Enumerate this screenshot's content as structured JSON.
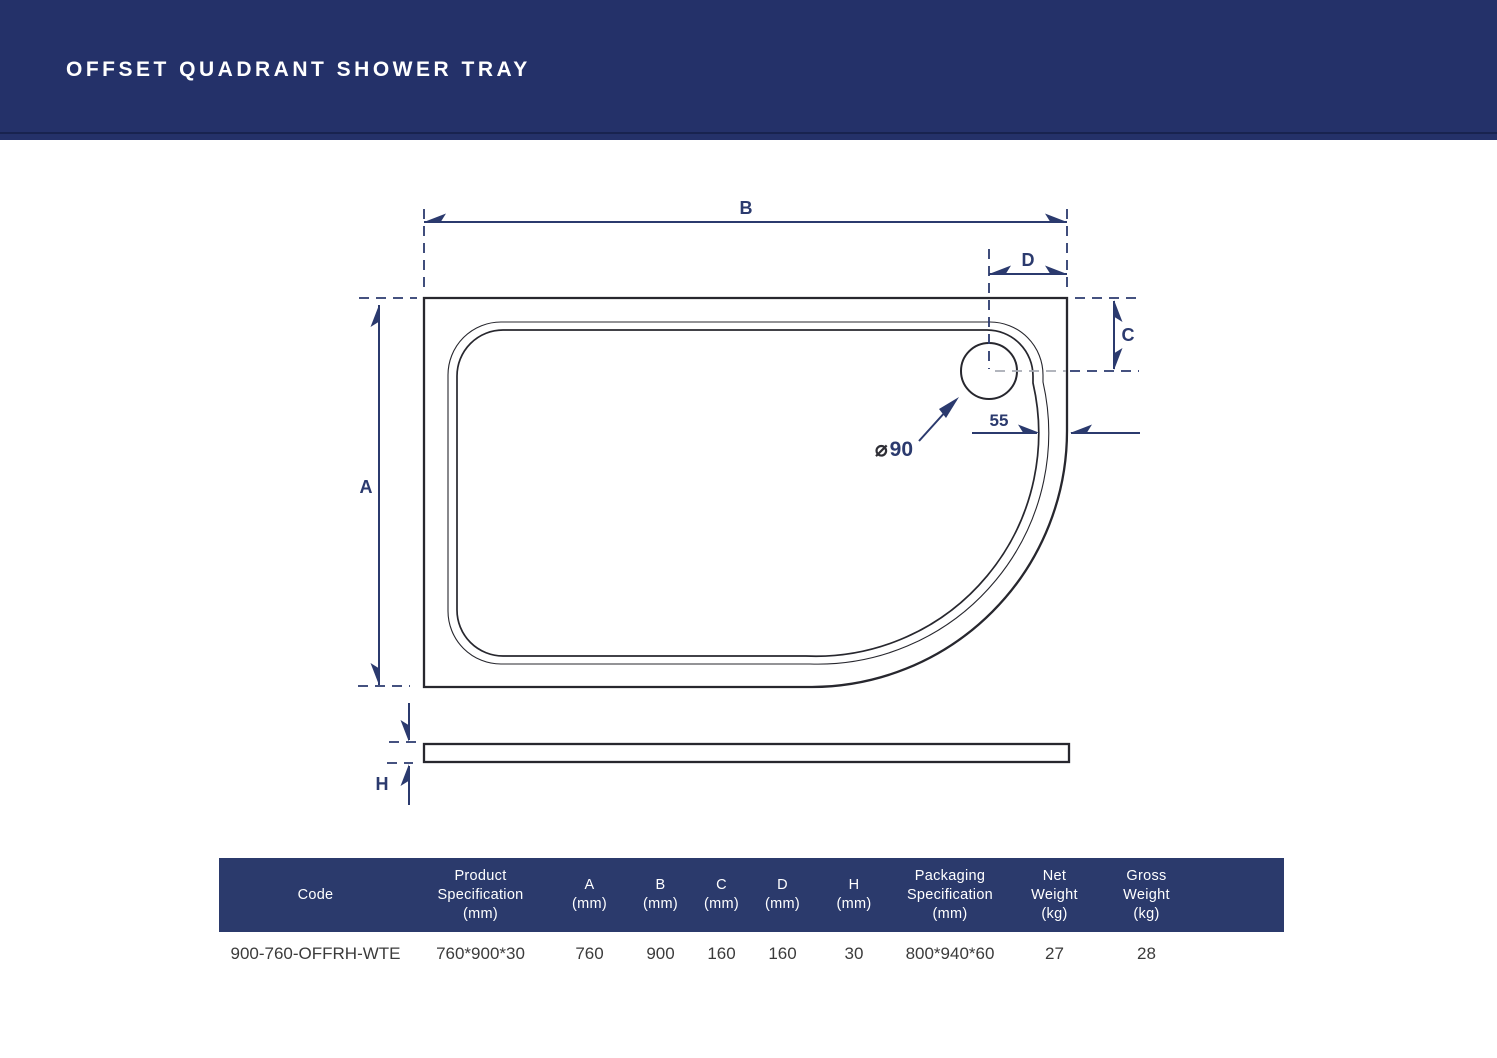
{
  "header": {
    "title": "OFFSET QUADRANT SHOWER TRAY"
  },
  "diagram": {
    "labels": {
      "width": "B",
      "drain_offset_x": "D",
      "drain_offset_y": "C",
      "depth": "A",
      "height": "H",
      "rim_width": "55",
      "drain_symbol": "⌀",
      "drain_size": "90"
    },
    "colors": {
      "navy": "#243169",
      "dimension": "#2b3a6e",
      "line": "#27272e"
    }
  },
  "table": {
    "columns": [
      {
        "lines": [
          "Code"
        ]
      },
      {
        "lines": [
          "Product",
          "Specification",
          "(mm)"
        ]
      },
      {
        "lines": [
          "A",
          "(mm)"
        ]
      },
      {
        "lines": [
          "B",
          "(mm)"
        ]
      },
      {
        "lines": [
          "C",
          "(mm)"
        ]
      },
      {
        "lines": [
          "D",
          "(mm)"
        ]
      },
      {
        "lines": [
          "H",
          "(mm)"
        ]
      },
      {
        "lines": [
          "Packaging",
          "Specification",
          "(mm)"
        ]
      },
      {
        "lines": [
          "Net",
          "Weight",
          "(kg)"
        ]
      },
      {
        "lines": [
          "Gross",
          "Weight",
          "(kg)"
        ]
      }
    ],
    "row": {
      "code": "900-760-OFFRH-WTE",
      "product_spec": "760*900*30",
      "a": "760",
      "b": "900",
      "c": "160",
      "d": "160",
      "h": "30",
      "packaging_spec": "800*940*60",
      "net_weight": "27",
      "gross_weight": "28"
    }
  }
}
